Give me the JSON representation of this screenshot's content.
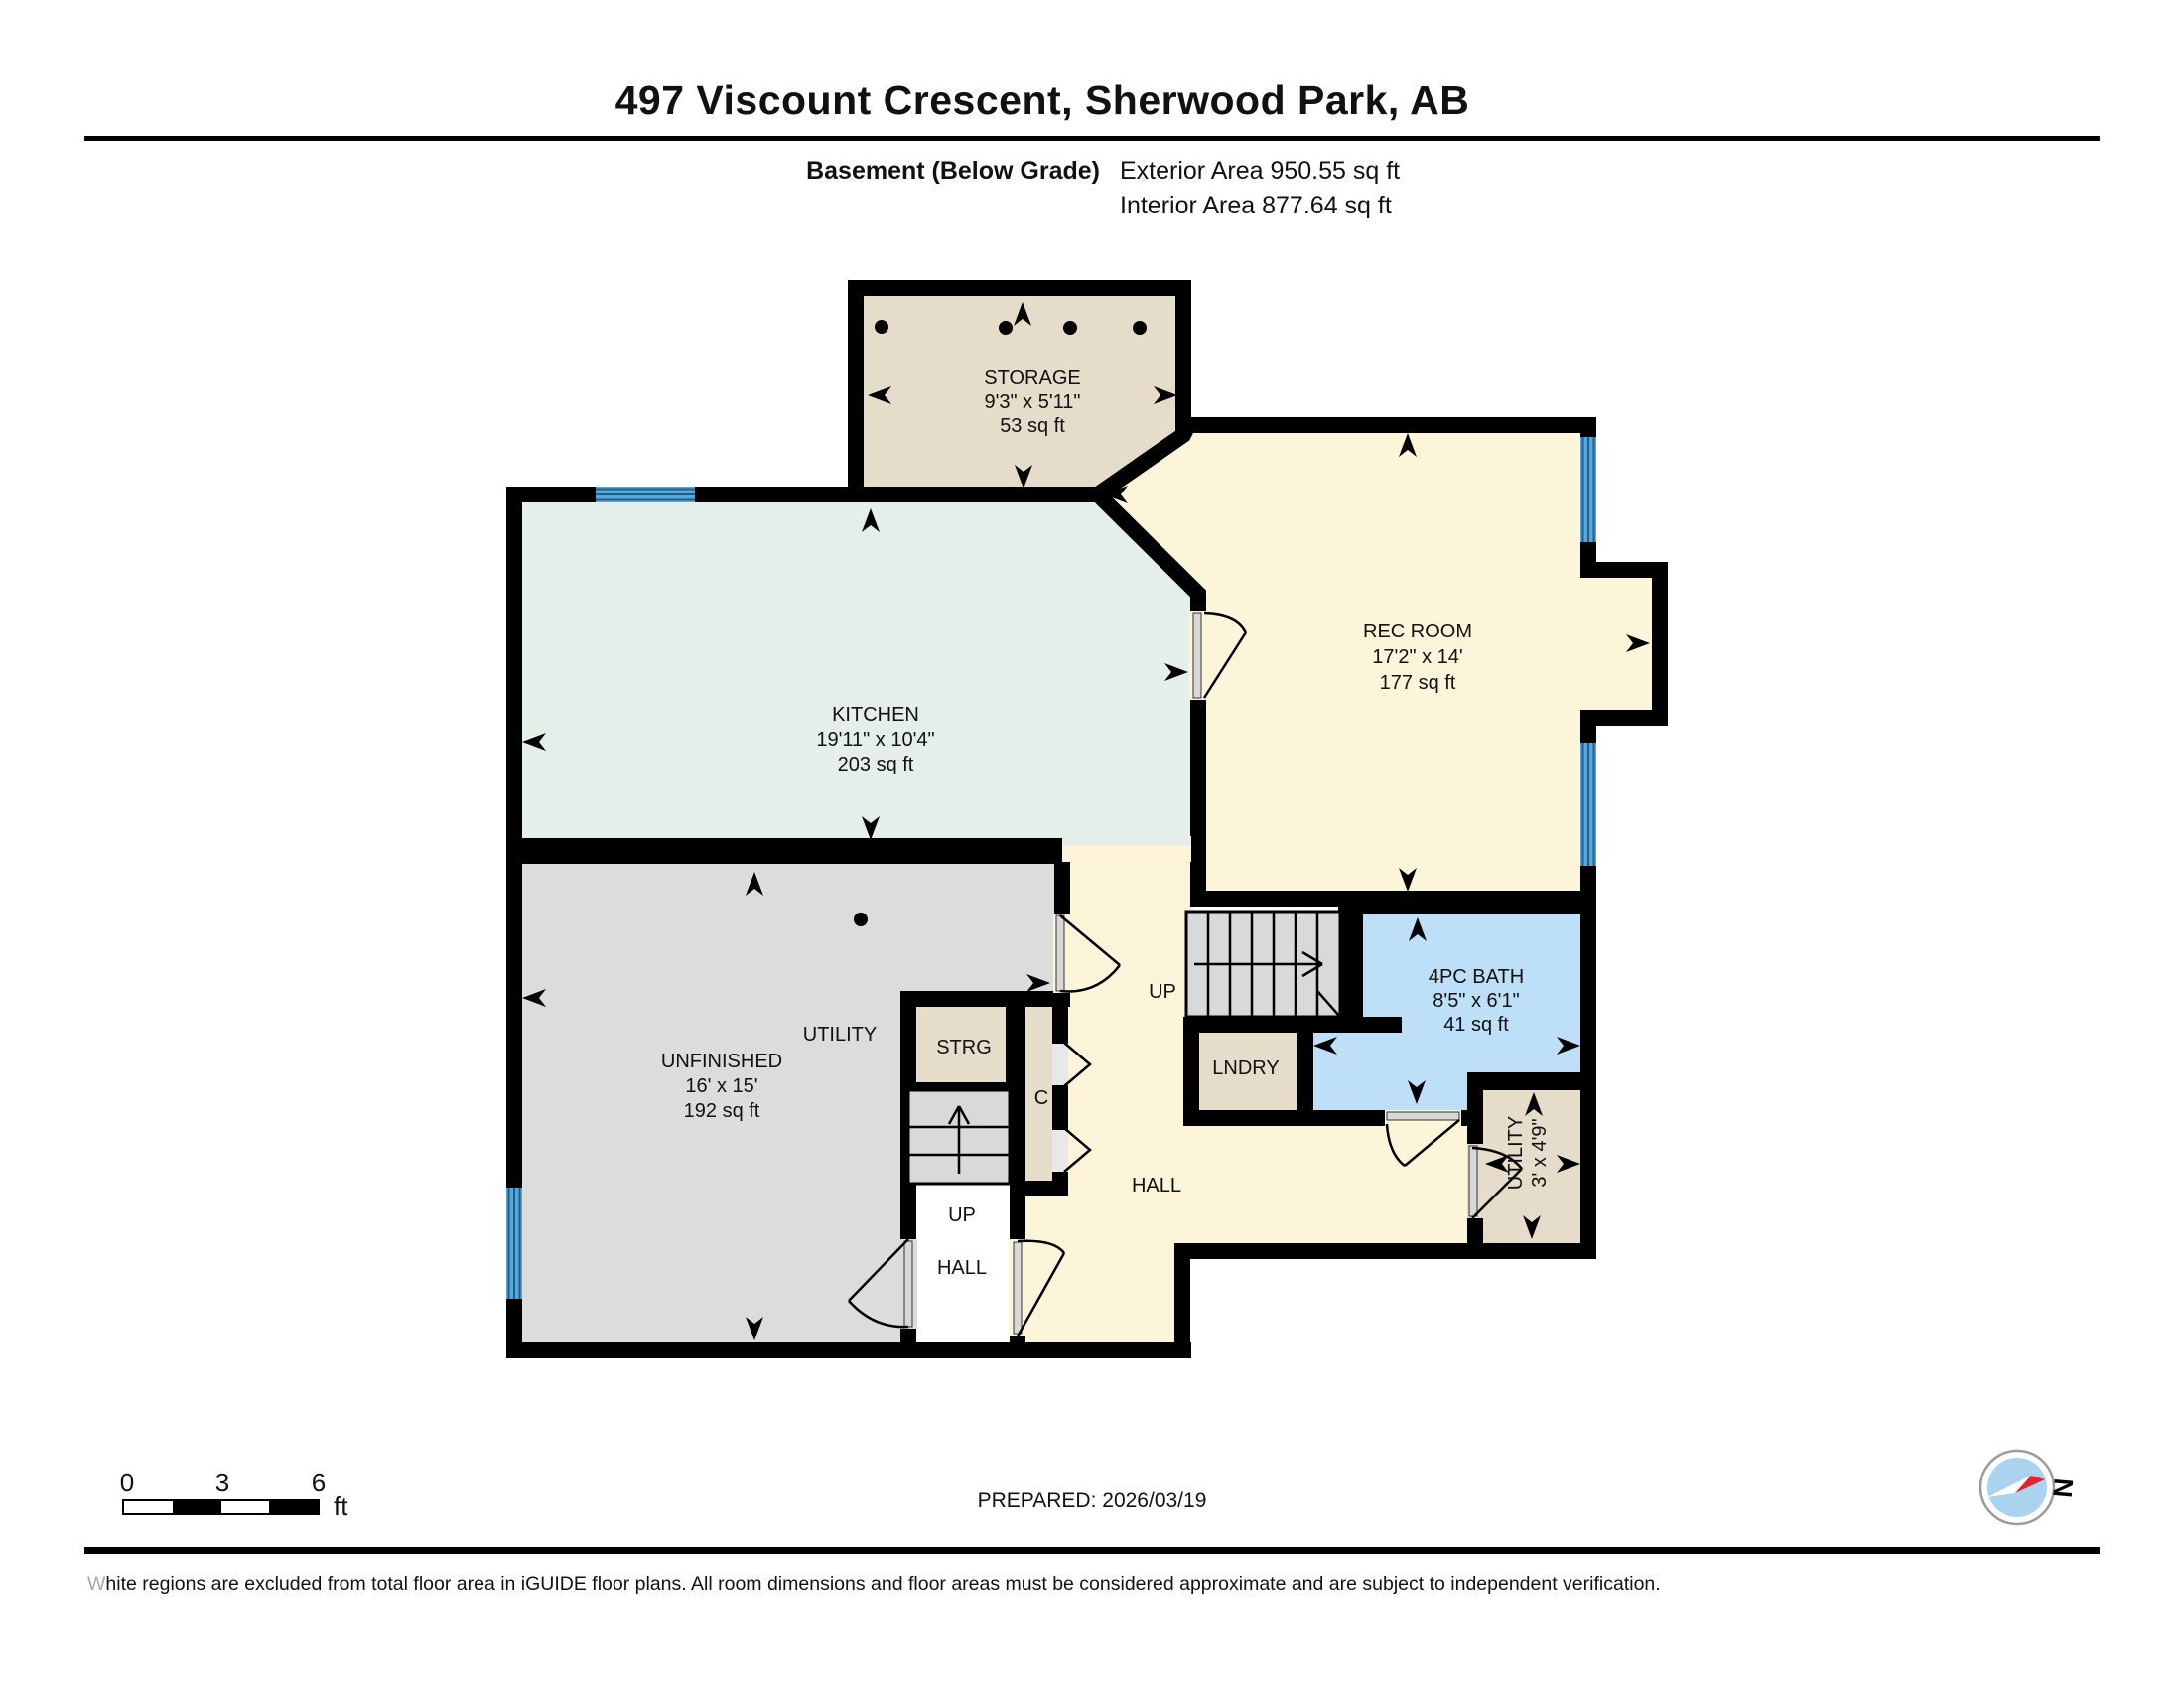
{
  "header": {
    "title": "497 Viscount Crescent, Sherwood Park, AB",
    "floor_label": "Basement (Below Grade)",
    "exterior_area": "Exterior Area 950.55 sq ft",
    "interior_area": "Interior Area 877.64 sq ft"
  },
  "rooms": {
    "storage": {
      "name": "STORAGE",
      "dims": "9'3\" x 5'11\"",
      "area": "53 sq ft"
    },
    "kitchen": {
      "name": "KITCHEN",
      "dims": "19'11\" x 10'4\"",
      "area": "203 sq ft"
    },
    "rec_room": {
      "name": "REC ROOM",
      "dims": "17'2\" x 14'",
      "area": "177 sq ft"
    },
    "unfinished": {
      "name": "UNFINISHED",
      "dims": "16' x 15'",
      "area": "192 sq ft"
    },
    "utility_area": {
      "name": "UTILITY"
    },
    "strg": {
      "name": "STRG"
    },
    "closet": {
      "name": "C"
    },
    "laundry": {
      "name": "LNDRY"
    },
    "bath": {
      "name": "4PC BATH",
      "dims": "8'5\" x 6'1\"",
      "area": "41 sq ft"
    },
    "utility_small": {
      "name": "UTILITY",
      "dims": "3' x 4'9\""
    },
    "hall": {
      "name": "HALL"
    },
    "hall_lower": {
      "name": "HALL"
    },
    "up_main": {
      "label": "UP"
    },
    "up_lower": {
      "label": "UP"
    }
  },
  "scale_bar": {
    "ticks": [
      "0",
      "3",
      "6"
    ],
    "unit": "ft"
  },
  "compass": {
    "north_label": "N"
  },
  "footer": {
    "prepared": "PREPARED: 2026/03/19",
    "disclaimer": "White regions are excluded from total floor area in iGUIDE floor plans. All room dimensions and floor areas must be considered approximate and are subject to independent verification."
  },
  "colors": {
    "wall": "#000000",
    "room_cream": "#fdf5da",
    "room_mint": "#e3efe8",
    "room_beige": "#e5dcc9",
    "room_gray": "#dcdcdc",
    "bath_blue": "#bedff8",
    "window_blue": "#58a7d8",
    "compass_red": "#e8212e",
    "compass_blue": "#a9d3ee"
  }
}
